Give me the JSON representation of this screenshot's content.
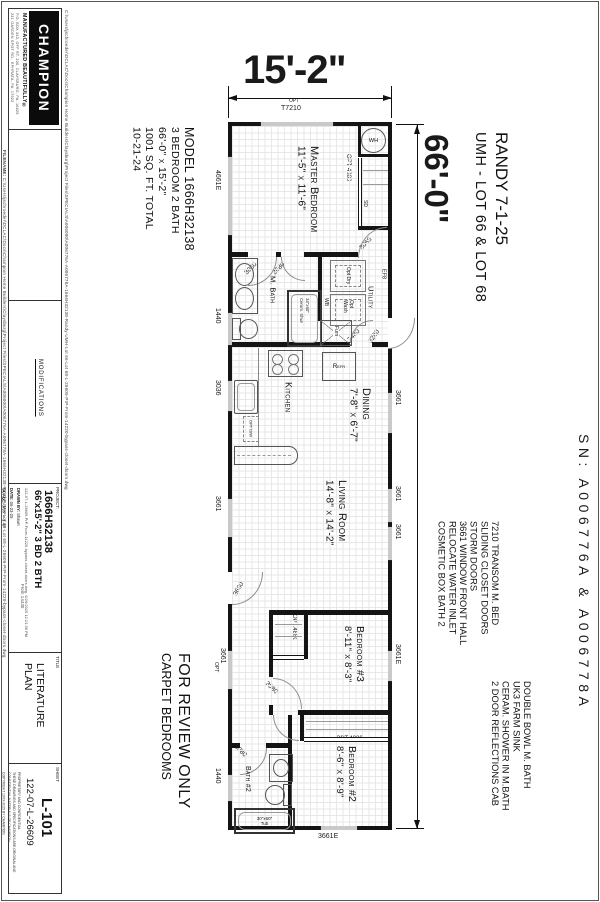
{
  "titleblock": {
    "logo": "CHAMPION",
    "tagline": "MANUFACTURED BEAUTIFULLY®",
    "address1": "P.O. BOX 343, OFF RT. 220, CLAYSBURG, PA. 16625",
    "address2": "231 GARDEN SPOT RD., EPHRATA, PA. 17522",
    "filename_label": "FILENAME:",
    "filepath": "C:\\Users\\jschroeder\\DCLAC\\Docs\\Champion Home Builders\\Claysburg\\Project Files\\SPECIALS\\A006000\\A006776A-A006778A-1666H32138-Randy-UMH-Lot 66-Lot 68-L-26609-PrP-From-14220-bypass-closet-doors.dwg",
    "modifications": "MODIFICATIONS",
    "project_label": "PROJECT:",
    "project_number": "1666H32138",
    "project_desc": "66'x15'-2\" 3 BD 2 BTH",
    "project_file": "122-07-L-26609-PrP-From-14220-bypass-closet-doors.dwg, 6/20/2025 12:21:36 PM",
    "drawn_label": "DRAWN BY:",
    "drawn": "Shawn",
    "date_label": "DATE:",
    "date": "06-23-25",
    "scale_label": "SCALE:",
    "scale": "3/16\" = 1'-0\"",
    "from_note": "From 14430",
    "title_label": "TITLE",
    "title1": "LITERATURE",
    "title2": "PLAN",
    "sheet_label": "SHEET",
    "sheet_number": "L-101",
    "sheet_code": "122-07-L-26609",
    "prop1": "PROPRIETARY AND CONFIDENTIAL",
    "prop2": "THESE DRAWINGS AND SPECIFICATIONS ARE ORIGINAL AND CONFIDENTIAL MATERIALS OF CHAMPION",
    "prop3": "COPYRIGHT 19XX-2025 BY CHAMPION"
  },
  "annotations": {
    "width_dim": "15'-2\"",
    "length_dim": "66'-0\"",
    "customer": "RANDY 7-1-25",
    "lot": "UMH - LOT 66 & LOT 68",
    "review1": "FOR REVIEW ONLY",
    "review2": "CARPET BEDROOMS",
    "serial": "SN: A006776A & A006778A",
    "model_lines": [
      "MODEL 1666H32138",
      "3 BEDROOM 2 BATH",
      "66'-0\" x 15'-2\"",
      "1001 SQ. FT. TOTAL",
      "10-21-24"
    ],
    "notes_a": [
      "7210 TRANSOM M. BED",
      "SLIDING CLOSET DOORS",
      "STORM DOORS",
      "3661 WINDOW FRONT HALL",
      "RELOCATE WATER INLET",
      "COSMETIC BOX BATH 2"
    ],
    "notes_b": [
      "DOUBLE BOWL M. BATH",
      "UK3 FARM SINK",
      "CERAM. SHOWER IN M.BATH",
      "2 DOOR REFLECTIONS CAB"
    ]
  },
  "rooms": {
    "master": {
      "name": "Master Bedroom",
      "dims": "11'-5\" x 11'-6\""
    },
    "mbath": {
      "name": "M. Bath"
    },
    "utility": {
      "name": "Utility"
    },
    "kitchen": {
      "name": "Kitchen"
    },
    "dining": {
      "name": "Dining",
      "dims": "7'-8\" x 6'-7\""
    },
    "living": {
      "name": "Living Room",
      "dims": "14'-8\" x 14'-2\""
    },
    "bedroom3": {
      "name": "Bedroom #3",
      "dims": "8'-11\" x 8'-3\""
    },
    "bath2": {
      "name": "Bath #2"
    },
    "bedroom2": {
      "name": "Bedroom #2",
      "dims": "8'-6\" x 8'-9\""
    }
  },
  "windows": {
    "mb_side": "4661E",
    "bath": "1440",
    "kitchen": "3036",
    "living_left": "3661",
    "hall": "3661",
    "hall_opt": "OPT",
    "bath2": "1440",
    "dining": "3661",
    "living_right_a": "3661",
    "living_right_b": "3661",
    "bedroom3": "3661E",
    "bedroom2": "3661E",
    "mb_top_opt": "OPT",
    "mb_top": "T7210"
  },
  "doors": {
    "master": "3068",
    "mbath": "3080",
    "mbath2": "2680",
    "utility": "2480",
    "utility_ext": "3280",
    "front": "3680",
    "bedroom3": "3080",
    "bath2": "3080"
  },
  "closets": {
    "master": "OPT 4880",
    "bedroom3": "OPT.4880",
    "bedroom2": "OPT.4880"
  },
  "fixtures": {
    "water_heater": "WH",
    "smoke_detector": "SD",
    "refrigerator": "Refr",
    "furnace": "Furn",
    "dryer": "Opt Dry",
    "washer": "Opt Wash",
    "wb": "WB",
    "exhaust_fan": "EF8",
    "shower1": "34\"x60\"",
    "shower2": "Ceram. Shwr",
    "tub1": "30\"x60\"",
    "tub2": "Tub",
    "dishwasher": "OPT D/W"
  }
}
